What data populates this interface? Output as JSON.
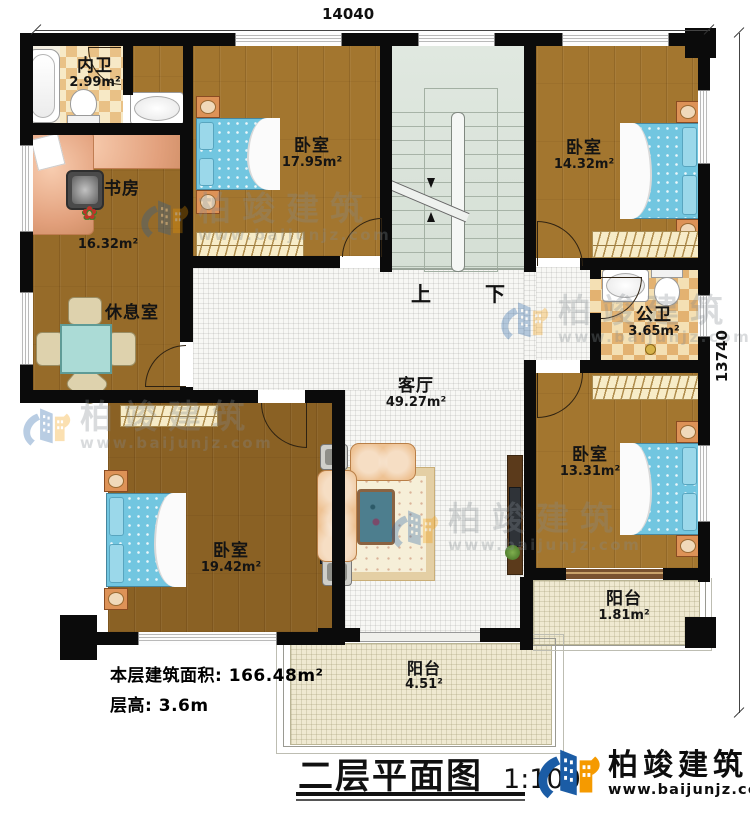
{
  "dims": {
    "top": "14040",
    "right": "13740"
  },
  "stairs": {
    "up": "上",
    "down": "下"
  },
  "rooms": {
    "neiwei": {
      "name": "内卫",
      "area": "2.99m²"
    },
    "shufang": {
      "name": "书房",
      "area": "16.32m²"
    },
    "xiuxishi": {
      "name": "休息室"
    },
    "bedroom_tl": {
      "name": "卧室",
      "area": "17.95m²"
    },
    "bedroom_tr": {
      "name": "卧室",
      "area": "14.32m²"
    },
    "gongwei": {
      "name": "公卫",
      "area": "3.65m²"
    },
    "keting": {
      "name": "客厅",
      "area": "49.27m²"
    },
    "bedroom_r": {
      "name": "卧室",
      "area": "13.31m²"
    },
    "bedroom_bl": {
      "name": "卧室",
      "area": "19.42m²"
    },
    "balcony_r": {
      "name": "阳台",
      "area": "1.81m²"
    },
    "balcony_b": {
      "name": "阳台",
      "area": "4.51²"
    }
  },
  "footer": {
    "area_label": "本层建筑面积:",
    "area_value": "166.48m²",
    "height_label": "层高:",
    "height_value": "3.6m",
    "title": "二层平面图",
    "scale": "1:100"
  },
  "brand": {
    "name": "柏竣建筑",
    "url": "www.baijunjz.com"
  },
  "watermark": {
    "name": "柏竣建筑",
    "url": "www.baijunjz.com"
  },
  "colors": {
    "wall": "#0b0b0b",
    "wood": "#a3762f",
    "accent_blue": "#1b5ca5",
    "accent_orange": "#f59a00",
    "bed": "#72c6e0"
  }
}
